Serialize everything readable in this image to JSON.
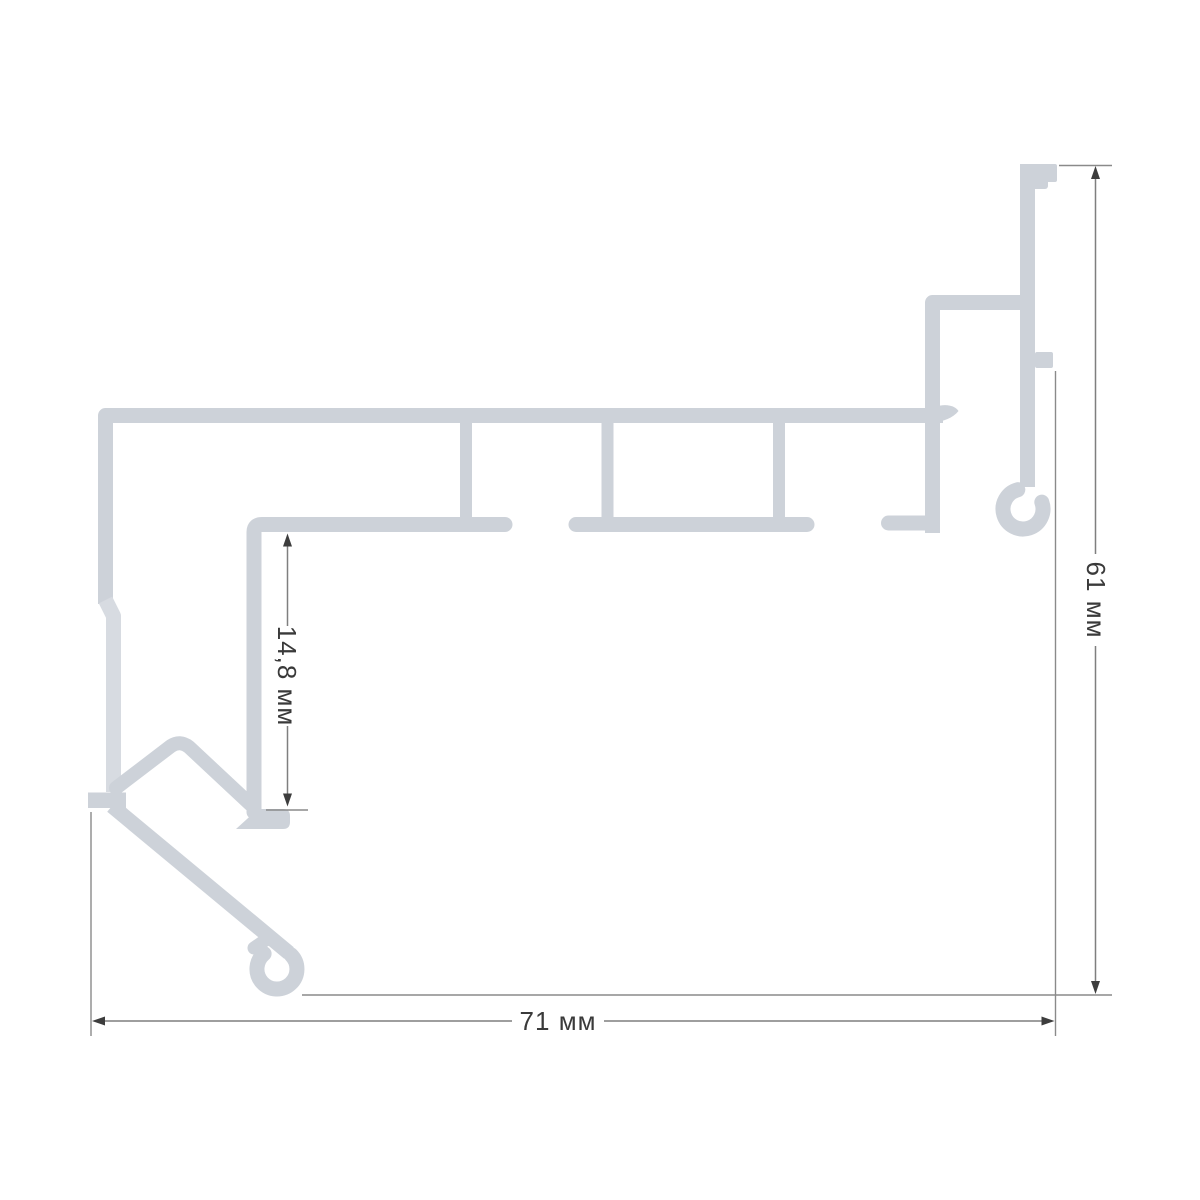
{
  "dimensions": {
    "width_label": "71 мм",
    "height_label": "61 мм",
    "inner_label": "14,8 мм"
  },
  "colors": {
    "profile": "#cdd2d9",
    "profile_light": "#d7dbe1",
    "background": "#ffffff",
    "dim_line": "#7f7f7f",
    "ext_line": "#8a8a8a",
    "arrow": "#3d3d3d",
    "text": "#3a3a3a"
  }
}
